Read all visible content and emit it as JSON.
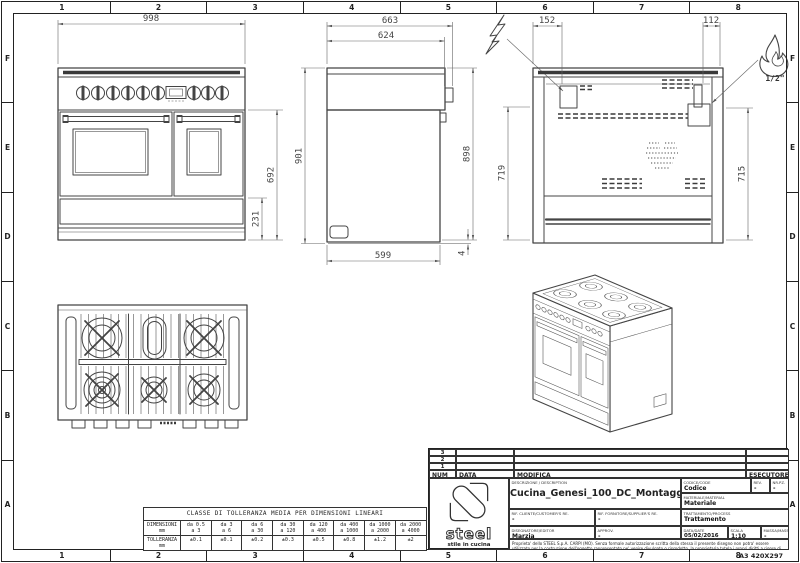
{
  "sheet": {
    "grid_columns": [
      "1",
      "2",
      "3",
      "4",
      "5",
      "6",
      "7",
      "8"
    ],
    "grid_rows": [
      "F",
      "E",
      "D",
      "C",
      "B",
      "A"
    ],
    "format_label": "A3 420X297"
  },
  "front_view": {
    "dim_width": "998",
    "dim_height": "692",
    "dim_drawer": "231"
  },
  "side_view": {
    "dim_depth_total": "663",
    "dim_depth_body": "624",
    "dim_height_front": "901",
    "dim_height_back": "898",
    "dim_depth_base": "599",
    "dim_foot_gap": "4"
  },
  "back_view": {
    "dim_elec_offset": "152",
    "dim_gas_offset": "112",
    "dim_height_left": "719",
    "dim_height_right": "715",
    "gas_size_label": "1/2\""
  },
  "tolerance_table": {
    "title": "CLASSE DI TOLLERANZA MEDIA PER DIMENSIONI LINEARI",
    "row_dim_label": "DIMENSIONI",
    "row_dim_unit": "mm",
    "row_tol_label": "TOLLERANZA",
    "row_tol_unit": "mm",
    "range_top": [
      "da 0.5",
      "da 3",
      "da 6",
      "da 30",
      "da 120",
      "da 400",
      "da 1000",
      "da 2000"
    ],
    "range_bottom": [
      "a 3",
      "a 6",
      "a 30",
      "a 120",
      "a 400",
      "a 1000",
      "a 2000",
      "a 4000"
    ],
    "tolerances": [
      "±0.1",
      "±0.1",
      "±0.2",
      "±0.3",
      "±0.5",
      "±0.8",
      "±1.2",
      "±2"
    ]
  },
  "title_block": {
    "revision_rows": [
      "3",
      "2",
      "1"
    ],
    "header_num": "NUM",
    "header_data": "DATA",
    "header_modifica": "MODIFICA",
    "header_esecutore": "ESECUTORE",
    "description_label": "DESCRIZIONE / DESCRIPTION",
    "description": "Cucina_Genesi_100_DC_Montaggio",
    "codice_label": "CODICE/CODE",
    "codice": "Codice",
    "rev_label": "REV.",
    "rev": "-",
    "nrpz_label": "NR.PZ.",
    "nrpz": "-",
    "materiale_label": "MATERIALE/MATERIAL",
    "materiale": "Materiale",
    "rif_cliente_label": "RIF. CLIENTE/CUSTOMER'S RE.",
    "rif_cliente": "-",
    "rif_fornitore_label": "RIF. FORNITORE/SUPPLIER'S RE.",
    "rif_fornitore": "-",
    "trattamento_label": "TRATTAMENTO/PROCESS",
    "trattamento": "Trattamento",
    "disegnatore_label": "DISEGNATORE/EDITOR",
    "disegnatore": "Marzia",
    "approv_label": "APPROV.",
    "approv": "-",
    "data_label": "DATA/DATE",
    "data": "05/02/2016",
    "scala_label": "SCALA",
    "scala": "1:10",
    "massa_label": "MASSA/MASS kg",
    "massa": "-",
    "legal": "Proprieta' dello STEEL S.p.A. CARPI (MO). Senza formale autorizzazione scritta della stessa il presente disegno non potra' essere utilizzato per la costruzione dell'oggetto rappresentato ne' venire divulgato o riprodotto, la proprietaria tutela i propri diritti a rigore di legge.",
    "logo_brand": "steel",
    "logo_tagline": "stile in cucina"
  }
}
